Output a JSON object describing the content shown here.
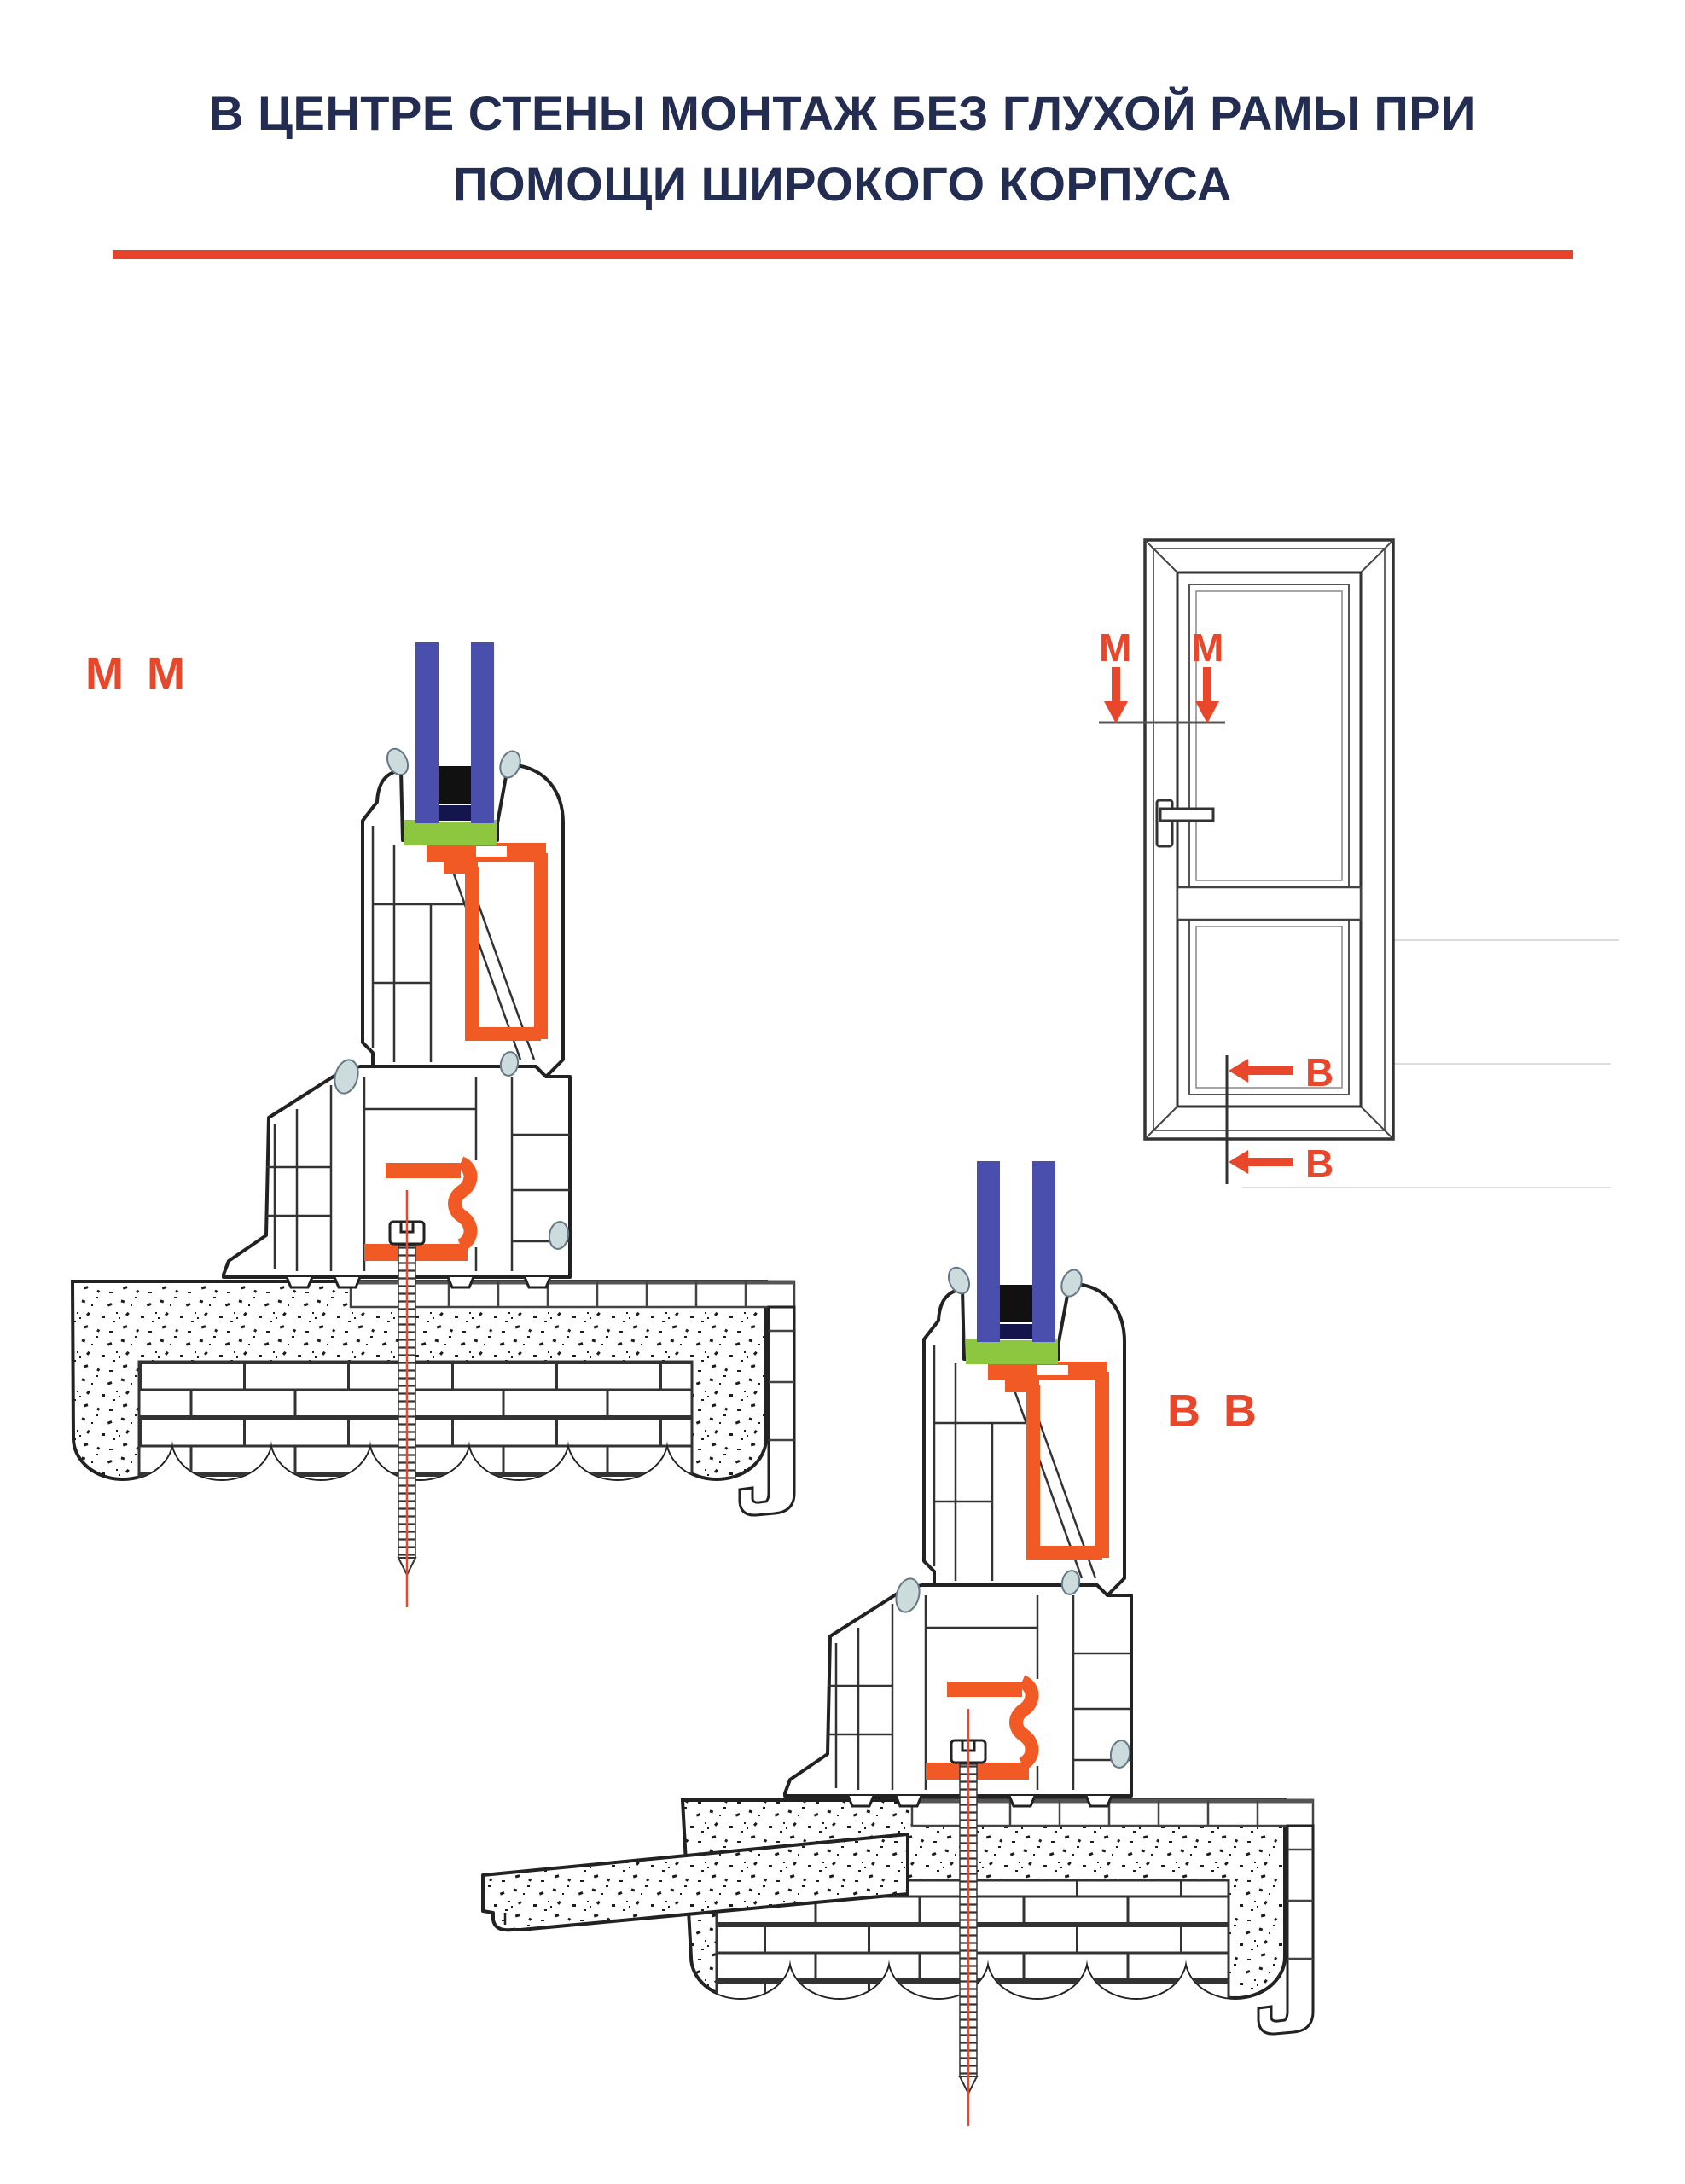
{
  "title": {
    "line1": "В ЦЕНТРЕ СТЕНЫ МОНТАЖ БЕЗ ГЛУХОЙ РАМЫ ПРИ",
    "line2": "ПОМОЩИ ШИРОКОГО КОРПУСА",
    "text_color": "#232d52",
    "underline_color": "#e8432a"
  },
  "sections": {
    "mm": {
      "label": "М М"
    },
    "bb": {
      "label": "В В"
    }
  },
  "elevation": {
    "marker_top_left": "М",
    "marker_top_right": "М",
    "marker_bottom_upper": "В",
    "marker_bottom_lower": "В"
  },
  "palette": {
    "outline": "#222222",
    "accent_red": "#e8432a",
    "label_red": "#e8472b",
    "steel_orange": "#f15a24",
    "glass_blue": "#4a4fae",
    "setting_block_green": "#8dc63f",
    "gasket_gray": "#ccdcdc",
    "wall_line": "#333333"
  }
}
